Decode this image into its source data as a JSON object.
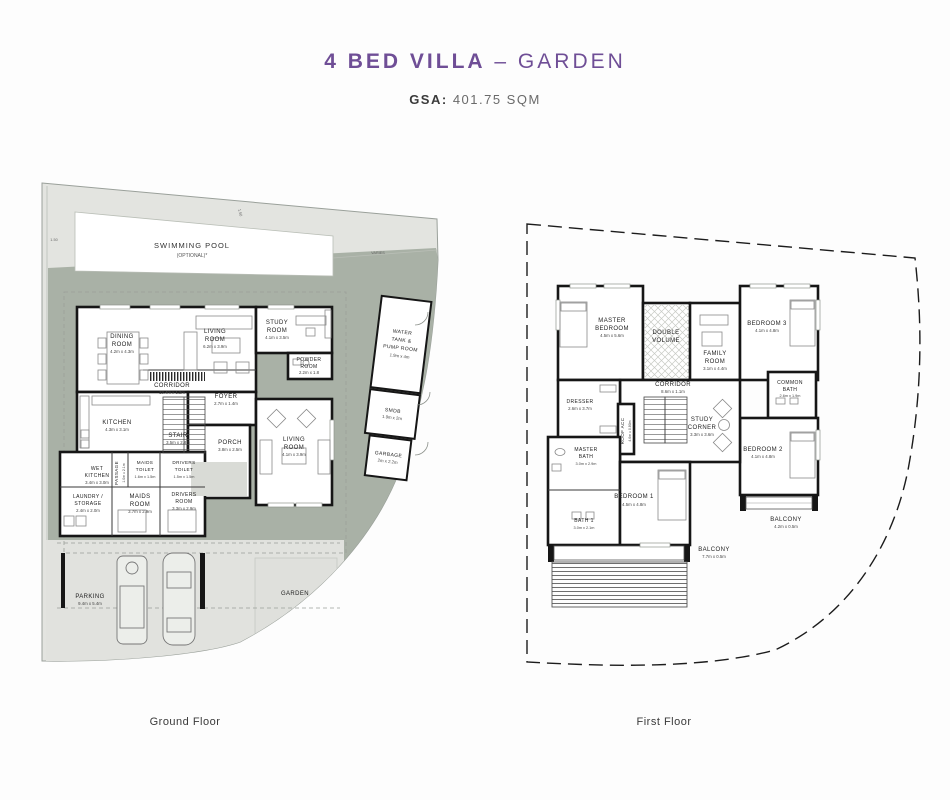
{
  "header": {
    "title_main": "4 BED VILLA",
    "title_rest": "– GARDEN",
    "gsa_label": "GSA:",
    "gsa_value": "401.75 SQM"
  },
  "captions": {
    "ground": "Ground Floor",
    "first": "First Floor"
  },
  "colors": {
    "accent_purple": "#6f4e96",
    "site_light": "#e3e4e0",
    "site_sage": "#a9b1a6",
    "wall": "#161616"
  },
  "site": {
    "pool_l1": "SWIMMING POOL",
    "pool_l2": "(OPTIONAL)*",
    "garden": "GARDEN",
    "varies": "VARIES",
    "setback_left": "1.50",
    "setback_top": "1.50",
    "parking": {
      "l1": "PARKING",
      "dims": "9.4m x 5.4m"
    }
  },
  "ground_rooms": {
    "dining": {
      "l1": "DINING",
      "l2": "ROOM",
      "dims": "4.2m x 4.3m"
    },
    "living": {
      "l1": "LIVING",
      "l2": "ROOM",
      "dims": "6.2m x 3.9m"
    },
    "study": {
      "l1": "STUDY",
      "l2": "ROOM",
      "dims": "4.1m x 3.5m"
    },
    "powder": {
      "l1": "POWDER",
      "l2": "ROOM",
      "dims": "2.2m x 1.8"
    },
    "corridor": {
      "l1": "CORRIDOR",
      "dims": "13.4m x 1.2m"
    },
    "foyer": {
      "l1": "FOYER",
      "dims": "2.7m x 1.4m"
    },
    "kitchen": {
      "l1": "KITCHEN",
      "dims": "4.3m x 3.1m"
    },
    "stair": {
      "l1": "STAIR",
      "dims": "3.5m x 2.8m"
    },
    "porch": {
      "l1": "PORCH",
      "dims": "3.8m x 2.5m"
    },
    "living2": {
      "l1": "LIVING",
      "l2": "ROOM",
      "dims": "4.1m x 3.9m"
    },
    "wet_kitchen": {
      "l1": "WET",
      "l2": "KITCHEN",
      "dims": "3.4m x 3.0m"
    },
    "passage": {
      "l1": "PASSAGE",
      "dims": "1.0m x 2.1m"
    },
    "maids_toilet": {
      "l1": "MAIDS",
      "l2": "TOILET",
      "dims": "1.6m x 1.5m"
    },
    "drivers_toilet": {
      "l1": "DRIVERS",
      "l2": "TOILET",
      "dims": "1.5m x 1.5m"
    },
    "maids_room": {
      "l1": "MAIDS",
      "l2": "ROOM",
      "dims": "3.7m x 2.9m"
    },
    "drivers_room": {
      "l1": "DRIVERS",
      "l2": "ROOM",
      "dims": "3.3m x 2.9m"
    },
    "laundry": {
      "l1": "LAUNDRY /",
      "l2": "STORAGE",
      "dims": "2.4m x 2.0m"
    },
    "water_tank": {
      "l1": "WATER",
      "l2": "TANK &",
      "l3": "PUMP ROOM",
      "dims": "1.9m x 4m"
    },
    "smdb": {
      "l1": "SMDB",
      "dims": "1.9m x 2m"
    },
    "garbage": {
      "l1": "GARBAGE",
      "dims": "2m x 2.2m"
    }
  },
  "first_rooms": {
    "master_bedroom": {
      "l1": "MASTER",
      "l2": "BEDROOM",
      "dims": "4.5m x 5.6m"
    },
    "double_volume": {
      "l1": "DOUBLE",
      "l2": "VOLUME"
    },
    "family_room": {
      "l1": "FAMILY",
      "l2": "ROOM",
      "dims": "3.1m x 4.4m"
    },
    "bedroom3": {
      "l1": "BEDROOM 3",
      "dims": "4.1m x 4.8m"
    },
    "corridor": {
      "l1": "CORRIDOR",
      "dims": "8.6m x 1.1m"
    },
    "common_bath": {
      "l1": "COMMON",
      "l2": "BATH",
      "dims": "2.6m x 1.9m"
    },
    "dresser": {
      "l1": "DRESSER",
      "dims": "2.6m x 3.7m"
    },
    "roof_acc": {
      "l1": "ROOF ACC",
      "dims": "4.6m x 0.80m"
    },
    "study_corner": {
      "l1": "STUDY",
      "l2": "CORNER",
      "dims": "3.3m x 3.6m"
    },
    "master_bath": {
      "l1": "MASTER",
      "l2": "BATH",
      "dims": "3.0m x 2.9m"
    },
    "bedroom2": {
      "l1": "BEDROOM 2",
      "dims": "4.1m x 4.8m"
    },
    "bedroom1": {
      "l1": "BEDROOM 1",
      "dims": "4.5m x 4.8m"
    },
    "bath1": {
      "l1": "BATH 1",
      "dims": "3.0m x 2.1m"
    },
    "balcony_right": {
      "l1": "BALCONY",
      "dims": "4.2m x 0.5m"
    },
    "balcony_bottom": {
      "l1": "BALCONY",
      "dims": "7.7m x 0.5m"
    }
  }
}
